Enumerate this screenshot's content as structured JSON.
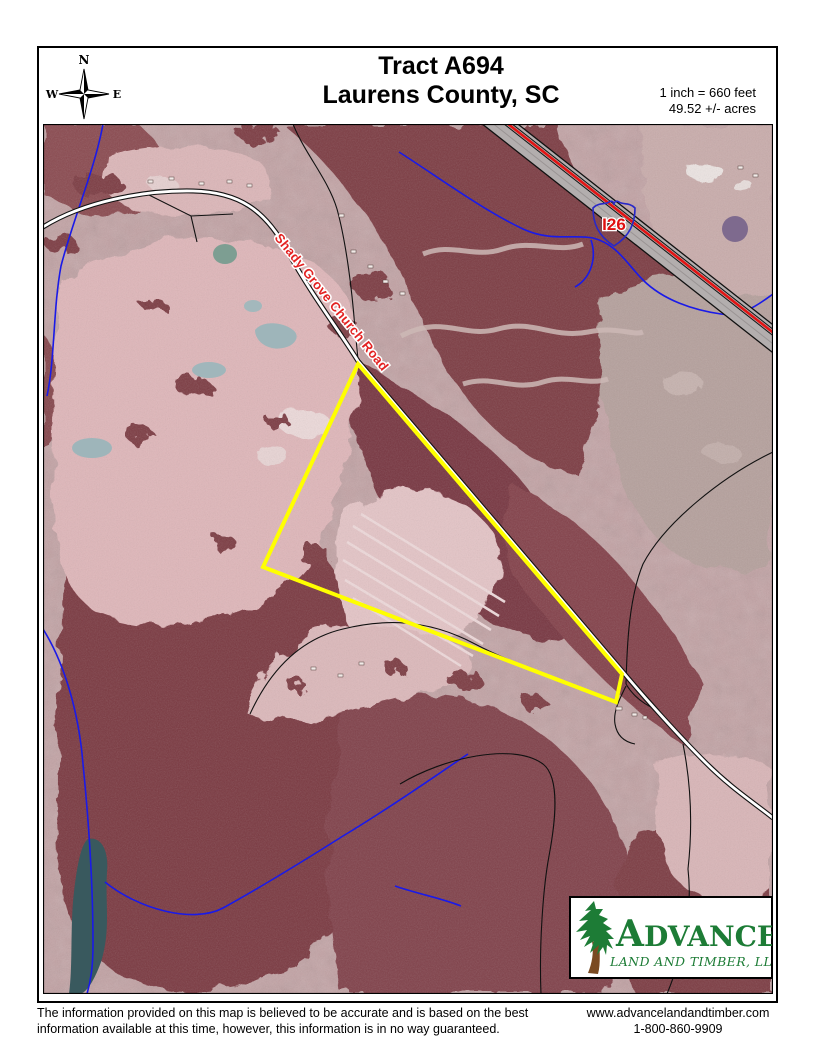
{
  "header": {
    "title_line1": "Tract A694",
    "title_line2": "Laurens County, SC",
    "scale_line1": "1 inch = 660 feet",
    "scale_line2": "49.52 +/- acres"
  },
  "compass": {
    "n": "N",
    "e": "E",
    "s": "S",
    "w": "W"
  },
  "map": {
    "road_label": "Shady Grove Church Road",
    "highway_shield_label": "I26"
  },
  "logo": {
    "name_initial": "A",
    "name_rest": "DVANCE",
    "subtitle": "LAND AND TIMBER, LLC"
  },
  "footer": {
    "disclaimer_line1": "The information provided on this map is believed to be accurate and is based on the best",
    "disclaimer_line2": "information available at this time, however, this information is in no way guaranteed.",
    "website": "www.advancelandandtimber.com",
    "phone": "1-800-860-9909"
  },
  "colors": {
    "tract_boundary": "#ffff00",
    "road_label_red": "#e32222",
    "shield_blue": "#2828c8",
    "shield_text_red": "#e01010",
    "stream_blue": "#1a1ae8",
    "highway_red": "#e31515",
    "highway_gray": "#b3aeae",
    "forest_maroon": "#7c3a43",
    "field_pink": "#dfb6b9",
    "aerial_base": "#c2a1a3",
    "logo_green": "#1d7c36",
    "trunk_brown": "#7a4a22"
  }
}
